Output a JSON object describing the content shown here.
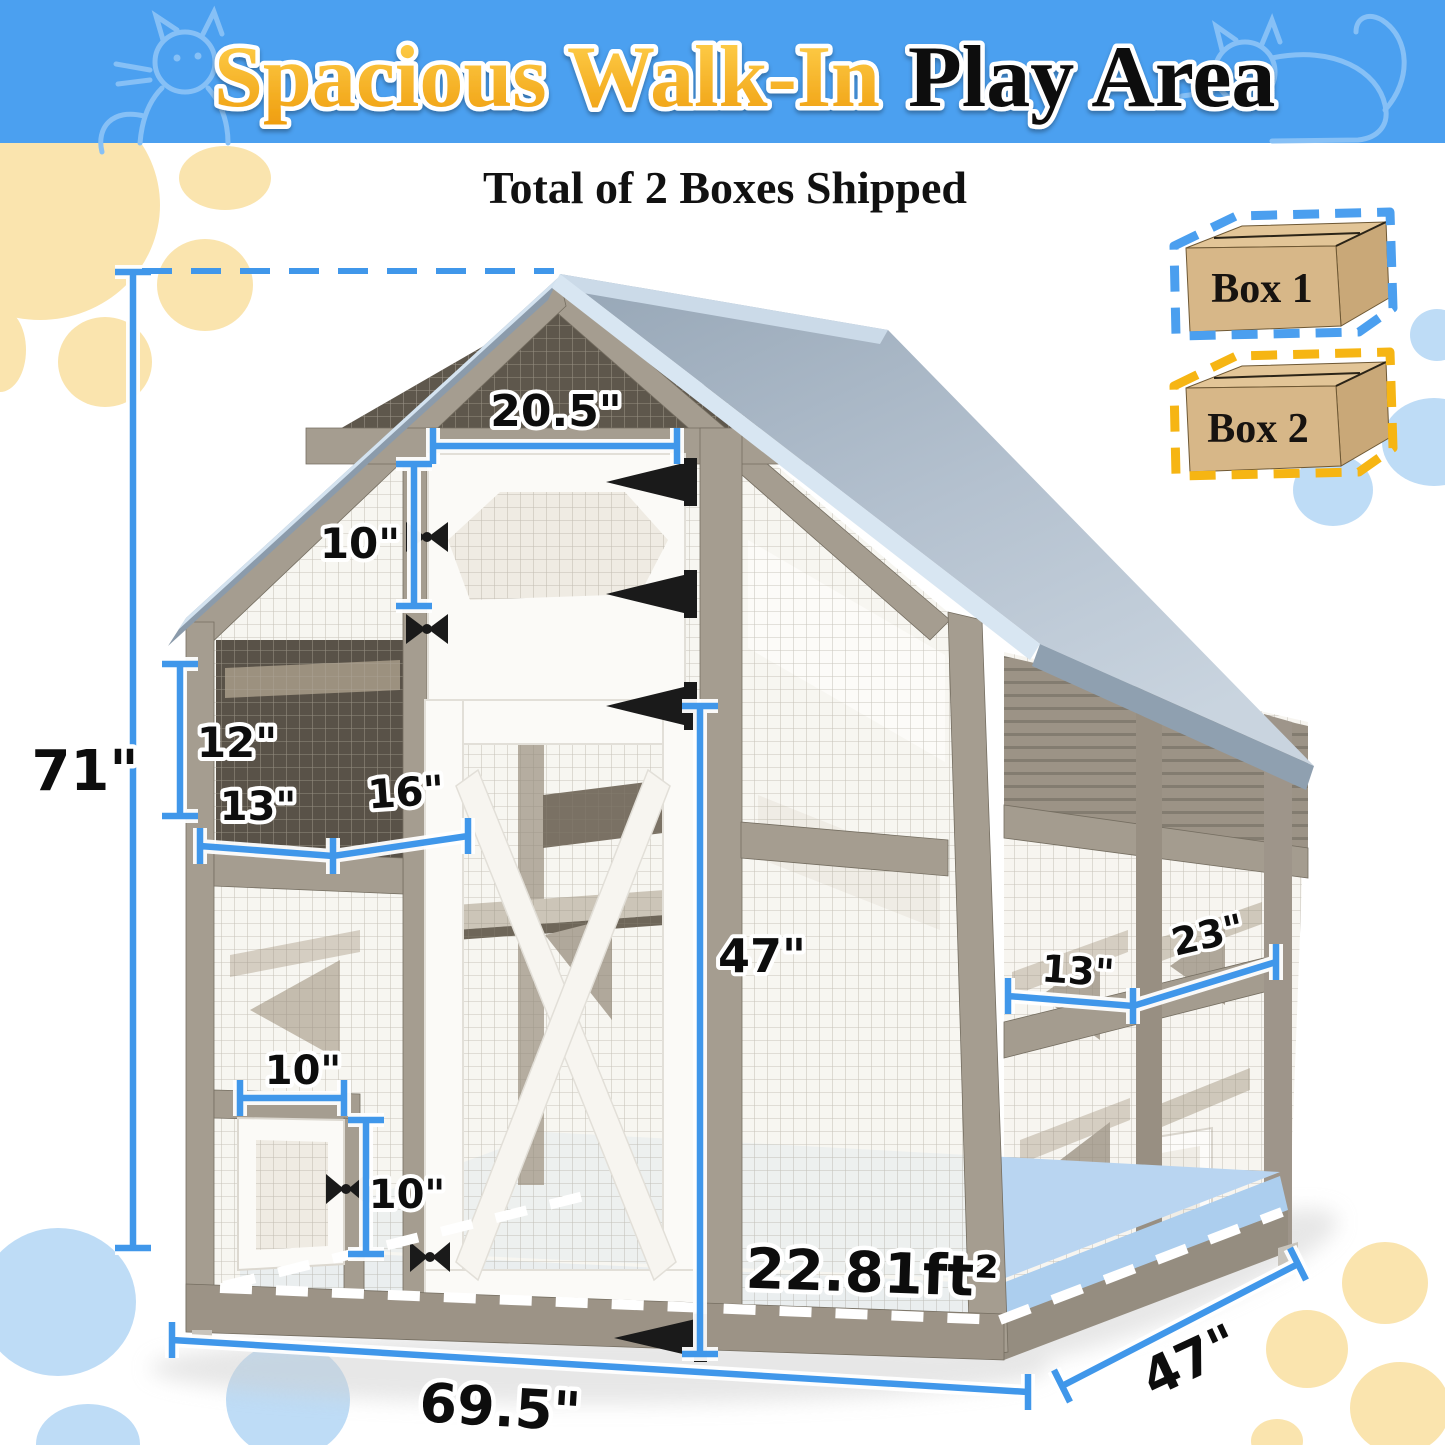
{
  "header": {
    "title_highlight": "Spacious Walk-In",
    "title_rest": "Play Area",
    "banner_color": "#4BA0F0",
    "highlight_color": "#F6A91C",
    "cat_outline_icons": "cat-silhouette-left, cat-silhouette-right"
  },
  "subtitle": "Total of 2 Boxes Shipped",
  "legend": {
    "boxes": [
      {
        "label": "Box 1",
        "outline_color": "#4B9FEF"
      },
      {
        "label": "Box 2",
        "outline_color": "#F6B513"
      }
    ]
  },
  "dimensions": {
    "total_height": "71\"",
    "top_door_width": "20.5\"",
    "top_door_height": "10\"",
    "left_panel_height": "12\"",
    "left_shelf_a": "13\"",
    "left_shelf_b": "16\"",
    "walk_in_door_height": "47\"",
    "right_shelf_a": "13\"",
    "right_shelf_b": "23\"",
    "small_door_width": "10\"",
    "small_door_height": "10\"",
    "base_width": "69.5\"",
    "base_depth": "47\"",
    "floor_area": "22.81ft²"
  },
  "colors": {
    "dimension_line": "#4097EA",
    "roof_gray_blue": "#A9B8C6",
    "roof_trim": "#D8E6F2",
    "wood_taupe": "#A59D90",
    "floor_highlight": "#A5CAED",
    "dots_yellow": "#FAE4AE",
    "dots_blue": "#BEDCF6",
    "cardboard": "#D7B788",
    "hinge_black": "#1A1A1A"
  }
}
